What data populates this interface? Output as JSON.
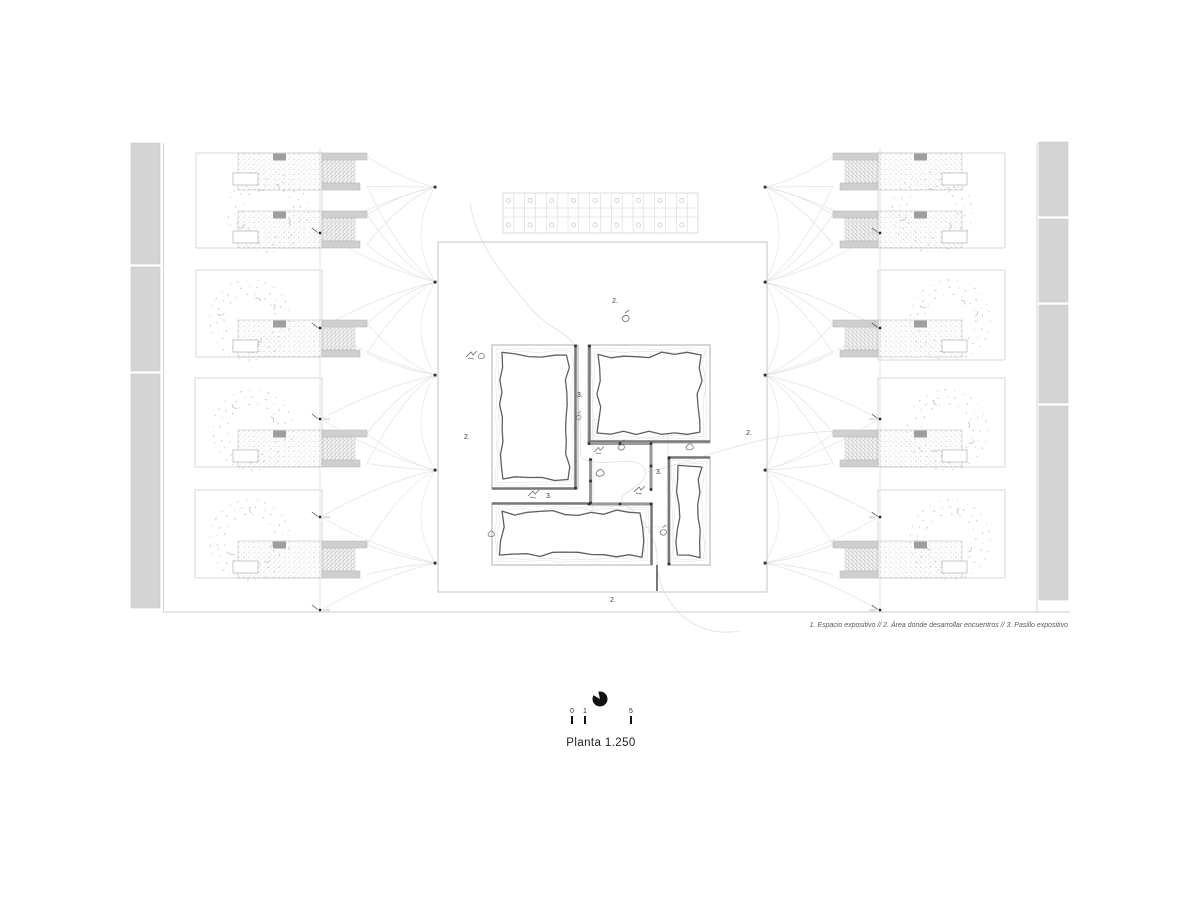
{
  "drawing": {
    "title": "Planta 1.250",
    "legend": "1. Espacio expositivo // 2. Área donde desarrollar encuentros // 3. Pasillo expositivo",
    "labels": {
      "area": "2.",
      "corridor": "3."
    },
    "scale_bar": {
      "t0": "0",
      "t1": "1",
      "t5": "5"
    },
    "colors": {
      "wall_dark": "#787878",
      "wall_room": "#9a9a9a",
      "line_light": "#c9c9c9",
      "path_faint": "#e3e3e3",
      "bar_gray": "#d2d2d2",
      "ink": "#1c1c1c"
    }
  }
}
